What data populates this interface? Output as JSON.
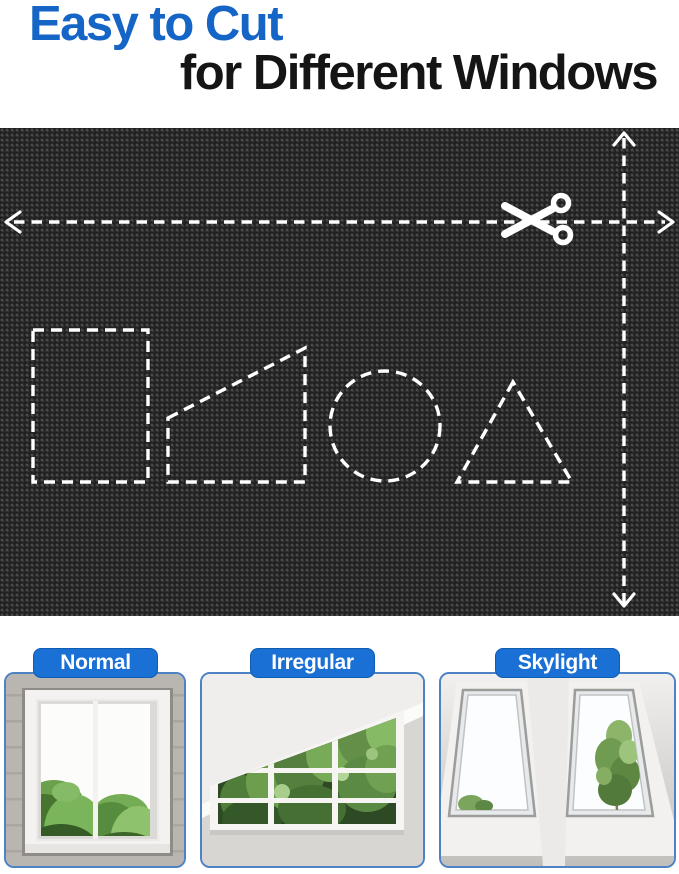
{
  "title": {
    "line1": "Easy to Cut",
    "line2": "for Different Windows"
  },
  "fabric_demo": {
    "icon": "scissors-icon",
    "arrows": [
      "width-cut-arrow-horizontal",
      "height-cut-arrow-vertical"
    ],
    "cut_shapes": [
      "rectangle",
      "trapezoid",
      "circle",
      "triangle"
    ]
  },
  "window_types": [
    {
      "label": "Normal"
    },
    {
      "label": "Irregular"
    },
    {
      "label": "Skylight"
    }
  ],
  "colors": {
    "title_blue": "#1565c6",
    "label_blue": "#1a70d4",
    "card_border_blue": "#4d82c4",
    "fabric_black": "#242424",
    "dash_white": "#ffffff"
  }
}
